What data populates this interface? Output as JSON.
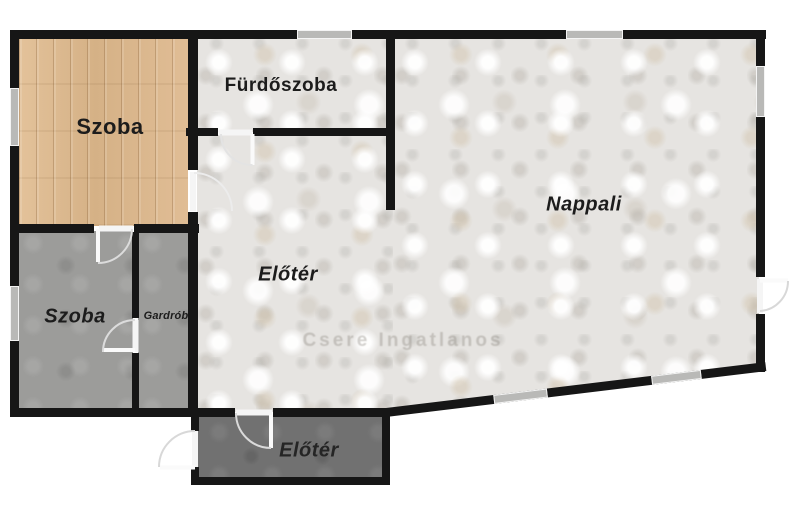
{
  "rooms": [
    {
      "label": "Szoba",
      "floor": "wood",
      "name": "room-label-szoba-top"
    },
    {
      "label": "Fürdőszoba",
      "floor": "marble",
      "name": "room-label-furdoszoba"
    },
    {
      "label": "Nappali",
      "floor": "marble",
      "name": "room-label-nappali"
    },
    {
      "label": "Előtér",
      "floor": "marble",
      "name": "room-label-eloter-hall"
    },
    {
      "label": "Szoba",
      "floor": "gray",
      "name": "room-label-szoba-bottom"
    },
    {
      "label": "Gardrób",
      "floor": "gray",
      "name": "room-label-gardrob"
    },
    {
      "label": "Előtér",
      "floor": "dark",
      "name": "room-label-eloter-entry"
    }
  ],
  "watermark": {
    "text": "Csere Ingatlanos"
  },
  "colors": {
    "wall": "#161616",
    "wood_floor": "#dcb88f",
    "marble_floor": "#e6e4e1",
    "gray_floor": "#9c9c9a",
    "dark_floor": "#717171",
    "window_fill": "#b9b9b7",
    "door_arc": "#e3e3e3",
    "label_text": "#1c1c1c",
    "background": "#ffffff"
  },
  "plan": {
    "floors": [
      {
        "name": "floor-szoba-top",
        "tex": "wood",
        "x": 19,
        "y": 38,
        "w": 169,
        "h": 188
      },
      {
        "name": "floor-furdoszoba",
        "tex": "marble",
        "x": 197,
        "y": 38,
        "w": 193,
        "h": 94
      },
      {
        "name": "floor-eloter-hall",
        "tex": "marble",
        "x": 197,
        "y": 135,
        "w": 198,
        "h": 277
      },
      {
        "name": "floor-nappali",
        "tex": "marble",
        "x": 393,
        "y": 38,
        "w": 366,
        "h": 376,
        "clip": "polygon(0 0, 100% 0, 100% 87%, 0 100%)"
      },
      {
        "name": "floor-szoba-bottom",
        "tex": "grayfloor",
        "x": 19,
        "y": 231,
        "w": 114,
        "h": 178
      },
      {
        "name": "floor-gardrob",
        "tex": "grayfloor",
        "x": 138,
        "y": 231,
        "w": 52,
        "h": 178
      },
      {
        "name": "floor-eloter-entry",
        "tex": "darkfloor",
        "x": 198,
        "y": 415,
        "w": 185,
        "h": 63
      }
    ],
    "walls": [
      {
        "x": 10,
        "y": 30,
        "w": 287,
        "h": 9
      },
      {
        "x": 352,
        "y": 30,
        "w": 214,
        "h": 9
      },
      {
        "x": 623,
        "y": 30,
        "w": 143,
        "h": 9
      },
      {
        "x": 186,
        "y": 128,
        "w": 32,
        "h": 8
      },
      {
        "x": 253,
        "y": 128,
        "w": 142,
        "h": 8
      },
      {
        "x": 10,
        "y": 224,
        "w": 84,
        "h": 9
      },
      {
        "x": 134,
        "y": 224,
        "w": 65,
        "h": 9
      },
      {
        "x": 10,
        "y": 408,
        "w": 225,
        "h": 9
      },
      {
        "x": 273,
        "y": 408,
        "w": 117,
        "h": 9
      },
      {
        "x": 193,
        "y": 477,
        "w": 197,
        "h": 8
      },
      {
        "x": 10,
        "y": 30,
        "w": 9,
        "h": 58
      },
      {
        "x": 10,
        "y": 146,
        "w": 9,
        "h": 140
      },
      {
        "x": 10,
        "y": 341,
        "w": 9,
        "h": 76
      },
      {
        "x": 188,
        "y": 38,
        "w": 10,
        "h": 132
      },
      {
        "x": 188,
        "y": 212,
        "w": 10,
        "h": 200
      },
      {
        "x": 191,
        "y": 408,
        "w": 8,
        "h": 23
      },
      {
        "x": 191,
        "y": 467,
        "w": 8,
        "h": 18
      },
      {
        "x": 132,
        "y": 232,
        "w": 7,
        "h": 86
      },
      {
        "x": 132,
        "y": 353,
        "w": 7,
        "h": 58
      },
      {
        "x": 386,
        "y": 38,
        "w": 9,
        "h": 172
      },
      {
        "x": 382,
        "y": 412,
        "w": 8,
        "h": 73
      },
      {
        "x": 756,
        "y": 30,
        "w": 9,
        "h": 36
      },
      {
        "x": 756,
        "y": 117,
        "w": 9,
        "h": 160
      },
      {
        "x": 756,
        "y": 314,
        "w": 9,
        "h": 58
      }
    ],
    "windows": [
      {
        "x": 297,
        "y": 30,
        "w": 55,
        "h": 9
      },
      {
        "x": 566,
        "y": 30,
        "w": 57,
        "h": 9
      },
      {
        "x": 10,
        "y": 88,
        "w": 9,
        "h": 58
      },
      {
        "x": 10,
        "y": 286,
        "w": 9,
        "h": 55
      },
      {
        "x": 756,
        "y": 66,
        "w": 9,
        "h": 51
      }
    ],
    "diagonal": {
      "x": 386,
      "y": 408,
      "len": 382,
      "h": 9,
      "angle": -6.9,
      "windows": [
        {
          "off": 108,
          "w": 54
        },
        {
          "off": 267,
          "w": 50
        }
      ]
    },
    "doors": [
      {
        "name": "door-furdoszoba",
        "jamb": "M219,132.5 L252,132.5",
        "leaf": "M252.5,134 L252.5,165",
        "arc": "M252.5,165 A31,31 0 0 1 221,134",
        "stroke": "#e3e3e3"
      },
      {
        "name": "door-szoba-top",
        "jamb": "M193,172 L193,211",
        "leaf": "",
        "arc": "M194,173 A38,38 0 0 1 232,211",
        "stroke": "#ececec"
      },
      {
        "name": "door-szoba-bottom",
        "jamb": "M99,228.5 L133,228.5",
        "leaf": "M98,229 L98,262",
        "arc": "M132,229 A34,34 0 0 1 98,263",
        "stroke": "#dcdcdc"
      },
      {
        "name": "door-gardrob",
        "jamb": "M135.5,320 L135.5,352",
        "leaf": "M103,350 L135,350",
        "arc": "M135,320 A32,32 0 0 0 103,352",
        "stroke": "#dcdcdc"
      },
      {
        "name": "door-eloter-entry-inner",
        "jamb": "M236,412.5 L272,412.5",
        "leaf": "M271,415 L271,448",
        "arc": "M271,448 A35,35 0 0 1 236,413",
        "stroke": "#dadada"
      },
      {
        "name": "door-front-entrance",
        "jamb": "M195,431 L195,467",
        "leaf": "M160,467.5 L195,467.5",
        "arc": "M195,431 A36,36 0 0 0 159,467",
        "stroke": "#d8d8d8"
      },
      {
        "name": "door-nappali-right",
        "jamb": "M760,279 L760,313",
        "leaf": "M760,280.5 L788,280.5",
        "arc": "M788,281 A30,30 0 0 1 760,311",
        "stroke": "#d8d8d8"
      }
    ]
  }
}
